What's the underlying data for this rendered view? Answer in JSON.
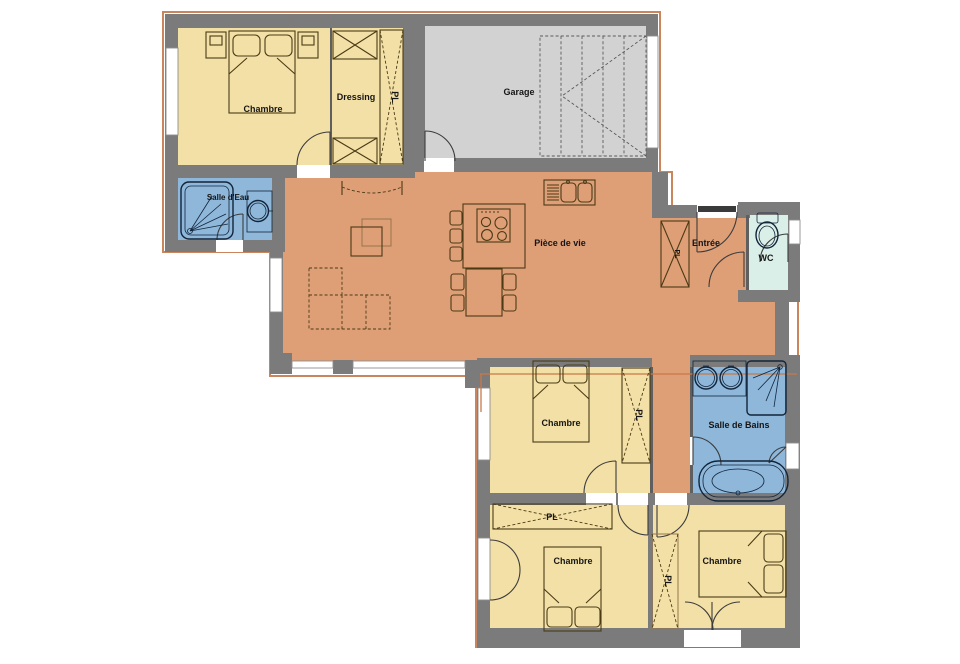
{
  "plan": {
    "type": "house-floor-plan",
    "language": "fr",
    "rooms": [
      {
        "id": "chambre-nw",
        "label": "Chambre"
      },
      {
        "id": "dressing",
        "label": "Dressing"
      },
      {
        "id": "placard-nw",
        "label": "PL"
      },
      {
        "id": "garage",
        "label": "Garage"
      },
      {
        "id": "salle-deau",
        "label": "Salle d'Eau"
      },
      {
        "id": "piece-de-vie",
        "label": "Pièce de vie"
      },
      {
        "id": "entree",
        "label": "Entrée"
      },
      {
        "id": "placard-entree",
        "label": "PL"
      },
      {
        "id": "wc",
        "label": "WC"
      },
      {
        "id": "chambre-mid",
        "label": "Chambre"
      },
      {
        "id": "placard-mid",
        "label": "PL"
      },
      {
        "id": "salle-de-bains",
        "label": "Salle de Bains"
      },
      {
        "id": "chambre-sw",
        "label": "Chambre"
      },
      {
        "id": "placard-sw",
        "label": "PL"
      },
      {
        "id": "chambre-se",
        "label": "Chambre"
      },
      {
        "id": "placard-se",
        "label": "PL"
      }
    ],
    "palette": {
      "wall": "#7b7b7b",
      "bedroom_floor": "#f3e0a6",
      "living_floor": "#de9e76",
      "bathroom_floor": "#8eb7da",
      "wc_floor": "#daefe8",
      "garage_floor": "#d2d2d2",
      "exterior_outline": "#c9855b",
      "section_line": "#c87848"
    }
  }
}
